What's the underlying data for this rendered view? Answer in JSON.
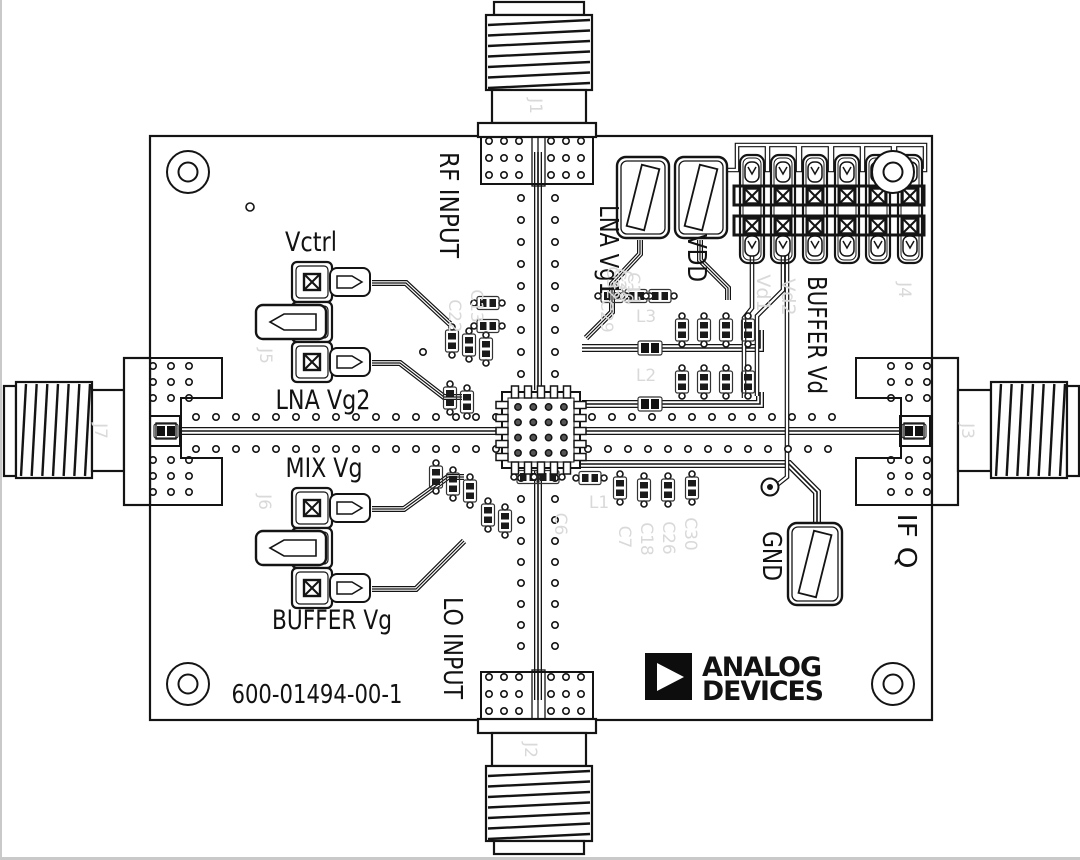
{
  "board": {
    "part_number": "600-01494-00-1",
    "logo": {
      "line1": "ANALOG",
      "line2": "DEVICES"
    },
    "labels": {
      "rf_input": "RF INPUT",
      "lo_input": "LO INPUT",
      "vctrl": "Vctrl",
      "lna_vg2": "LNA Vg2",
      "mix_vg": "MIX Vg",
      "buffer_vg": "BUFFER Vg",
      "lna_vg1": "LNA Vg1",
      "vdd": "VDD",
      "buffer_vd": "BUFFER Vd",
      "gnd": "GND",
      "if_q": "IF Q"
    },
    "refdes": {
      "j1": "J1",
      "j2": "J2",
      "j3": "J3",
      "j4": "J4",
      "j5": "J5",
      "j6": "J6",
      "j7": "J7",
      "tp1": "TP1",
      "tp2": "TP2",
      "tp3": "TP3",
      "vd1": "Vd1",
      "vd2": "Vd2",
      "c13": "C13",
      "c22": "C22",
      "c29": "C29",
      "c32": "C32",
      "c28": "C28",
      "c20": "C20",
      "c11": "C11",
      "c6": "C6",
      "c7": "C7",
      "c18": "C18",
      "c26": "C26",
      "c30": "C30",
      "l1": "L1",
      "l2": "L2",
      "l3": "L3"
    },
    "colors": {
      "silkscreen": "#141414",
      "faint_silkscreen": "#d9d9d9",
      "background": "#ffffff"
    }
  }
}
